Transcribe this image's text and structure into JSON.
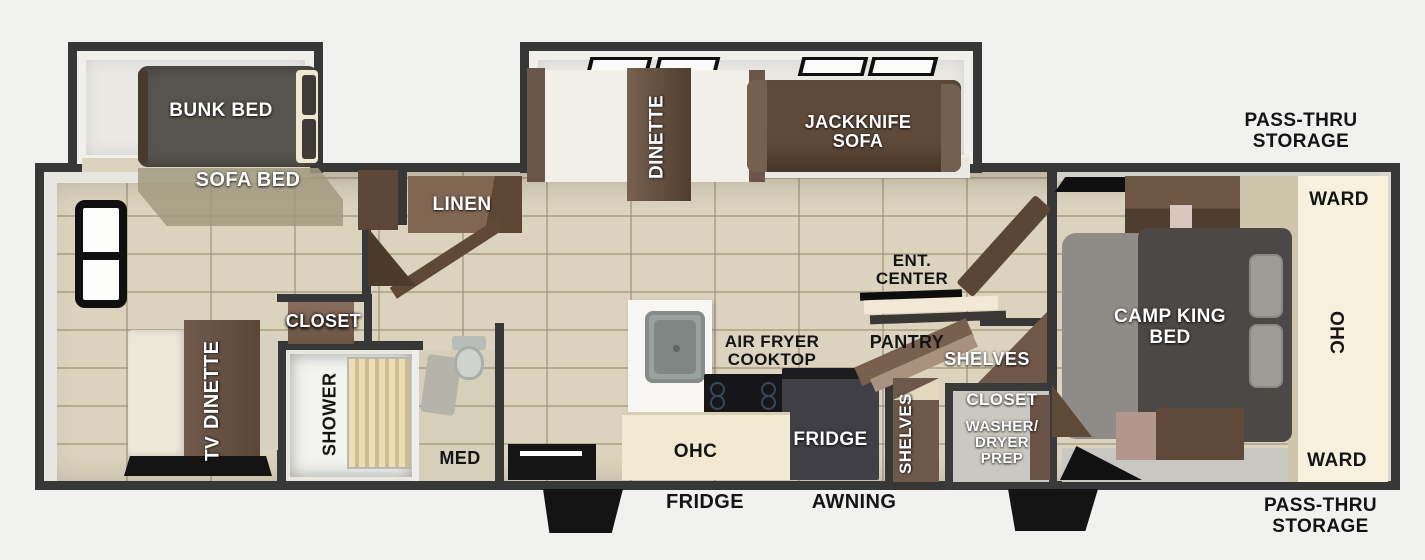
{
  "labels": {
    "bunk_bed": "BUNK BED",
    "sofa_bed": "SOFA BED",
    "dinette_left": "DINETTE",
    "tv": "TV",
    "closet_left": "CLOSET",
    "shower": "SHOWER",
    "med": "MED",
    "linen": "LINEN",
    "dinette_mid": "DINETTE",
    "jackknife_sofa": [
      "JACKKNIFE",
      "SOFA"
    ],
    "air_fryer_cooktop": [
      "AIR FRYER",
      "COOKTOP"
    ],
    "ohc_kitchen": "OHC",
    "fridge_interior": "FRIDGE",
    "shelves_tall": "SHELVES",
    "ent_center": [
      "ENT.",
      "CENTER"
    ],
    "pantry": "PANTRY",
    "shelves_wide": "SHELVES",
    "closet_utility": "CLOSET",
    "washer_dryer_prep": [
      "WASHER/",
      "DRYER",
      "PREP"
    ],
    "camp_king_bed": [
      "CAMP KING",
      "BED"
    ],
    "ward_top": "WARD",
    "ohc_bedroom": "OHC",
    "ward_bottom": "WARD",
    "pass_thru_top": [
      "PASS-THRU",
      "STORAGE"
    ],
    "pass_thru_bottom": [
      "PASS-THRU",
      "STORAGE"
    ],
    "fridge_exterior": "FRIDGE",
    "awning": "AWNING"
  },
  "colors": {
    "background": "#f1f1f0",
    "wall": "#373737",
    "tile_floor": "#dbd3bd",
    "slide_floor": "#e9e8e3",
    "wood_dark": "#5e4937",
    "wood_mid": "#77604e",
    "cream_cabinet": "#f2e9d3",
    "bed_dark_gray": "#4c4845",
    "bed_light_gray": "#8f8c87",
    "appliance_black": "#17171a",
    "label_white": "#ffffff",
    "label_black": "#141414"
  }
}
